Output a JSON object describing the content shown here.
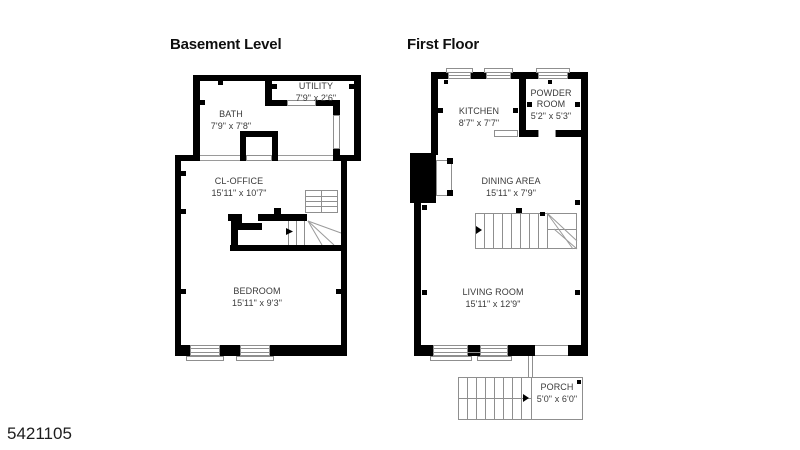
{
  "page": {
    "photo_id": "5421105",
    "background": "#ffffff"
  },
  "colors": {
    "wall": "#000000",
    "thin_line": "#8f8f8f",
    "label_text": "#3a3a3a",
    "title_text": "#0f0f0f"
  },
  "floors": [
    {
      "title": "Basement Level",
      "rooms": [
        {
          "name": "BATH",
          "dims": "7'9\" x 7'8\""
        },
        {
          "name": "UTILITY",
          "dims": "7'9\" x 2'6\""
        },
        {
          "name": "CL-OFFICE",
          "dims": "15'11\" x 10'7\""
        },
        {
          "name": "BEDROOM",
          "dims": "15'11\" x 9'3\""
        }
      ]
    },
    {
      "title": "First Floor",
      "rooms": [
        {
          "name": "KITCHEN",
          "dims": "8'7\" x 7'7\""
        },
        {
          "name": "POWDER ROOM",
          "dims": "5'2\" x 5'3\""
        },
        {
          "name": "DINING AREA",
          "dims": "15'11\" x 7'9\""
        },
        {
          "name": "LIVING ROOM",
          "dims": "15'11\" x 12'9\""
        },
        {
          "name": "PORCH",
          "dims": "5'0\" x 6'0\""
        }
      ]
    }
  ]
}
